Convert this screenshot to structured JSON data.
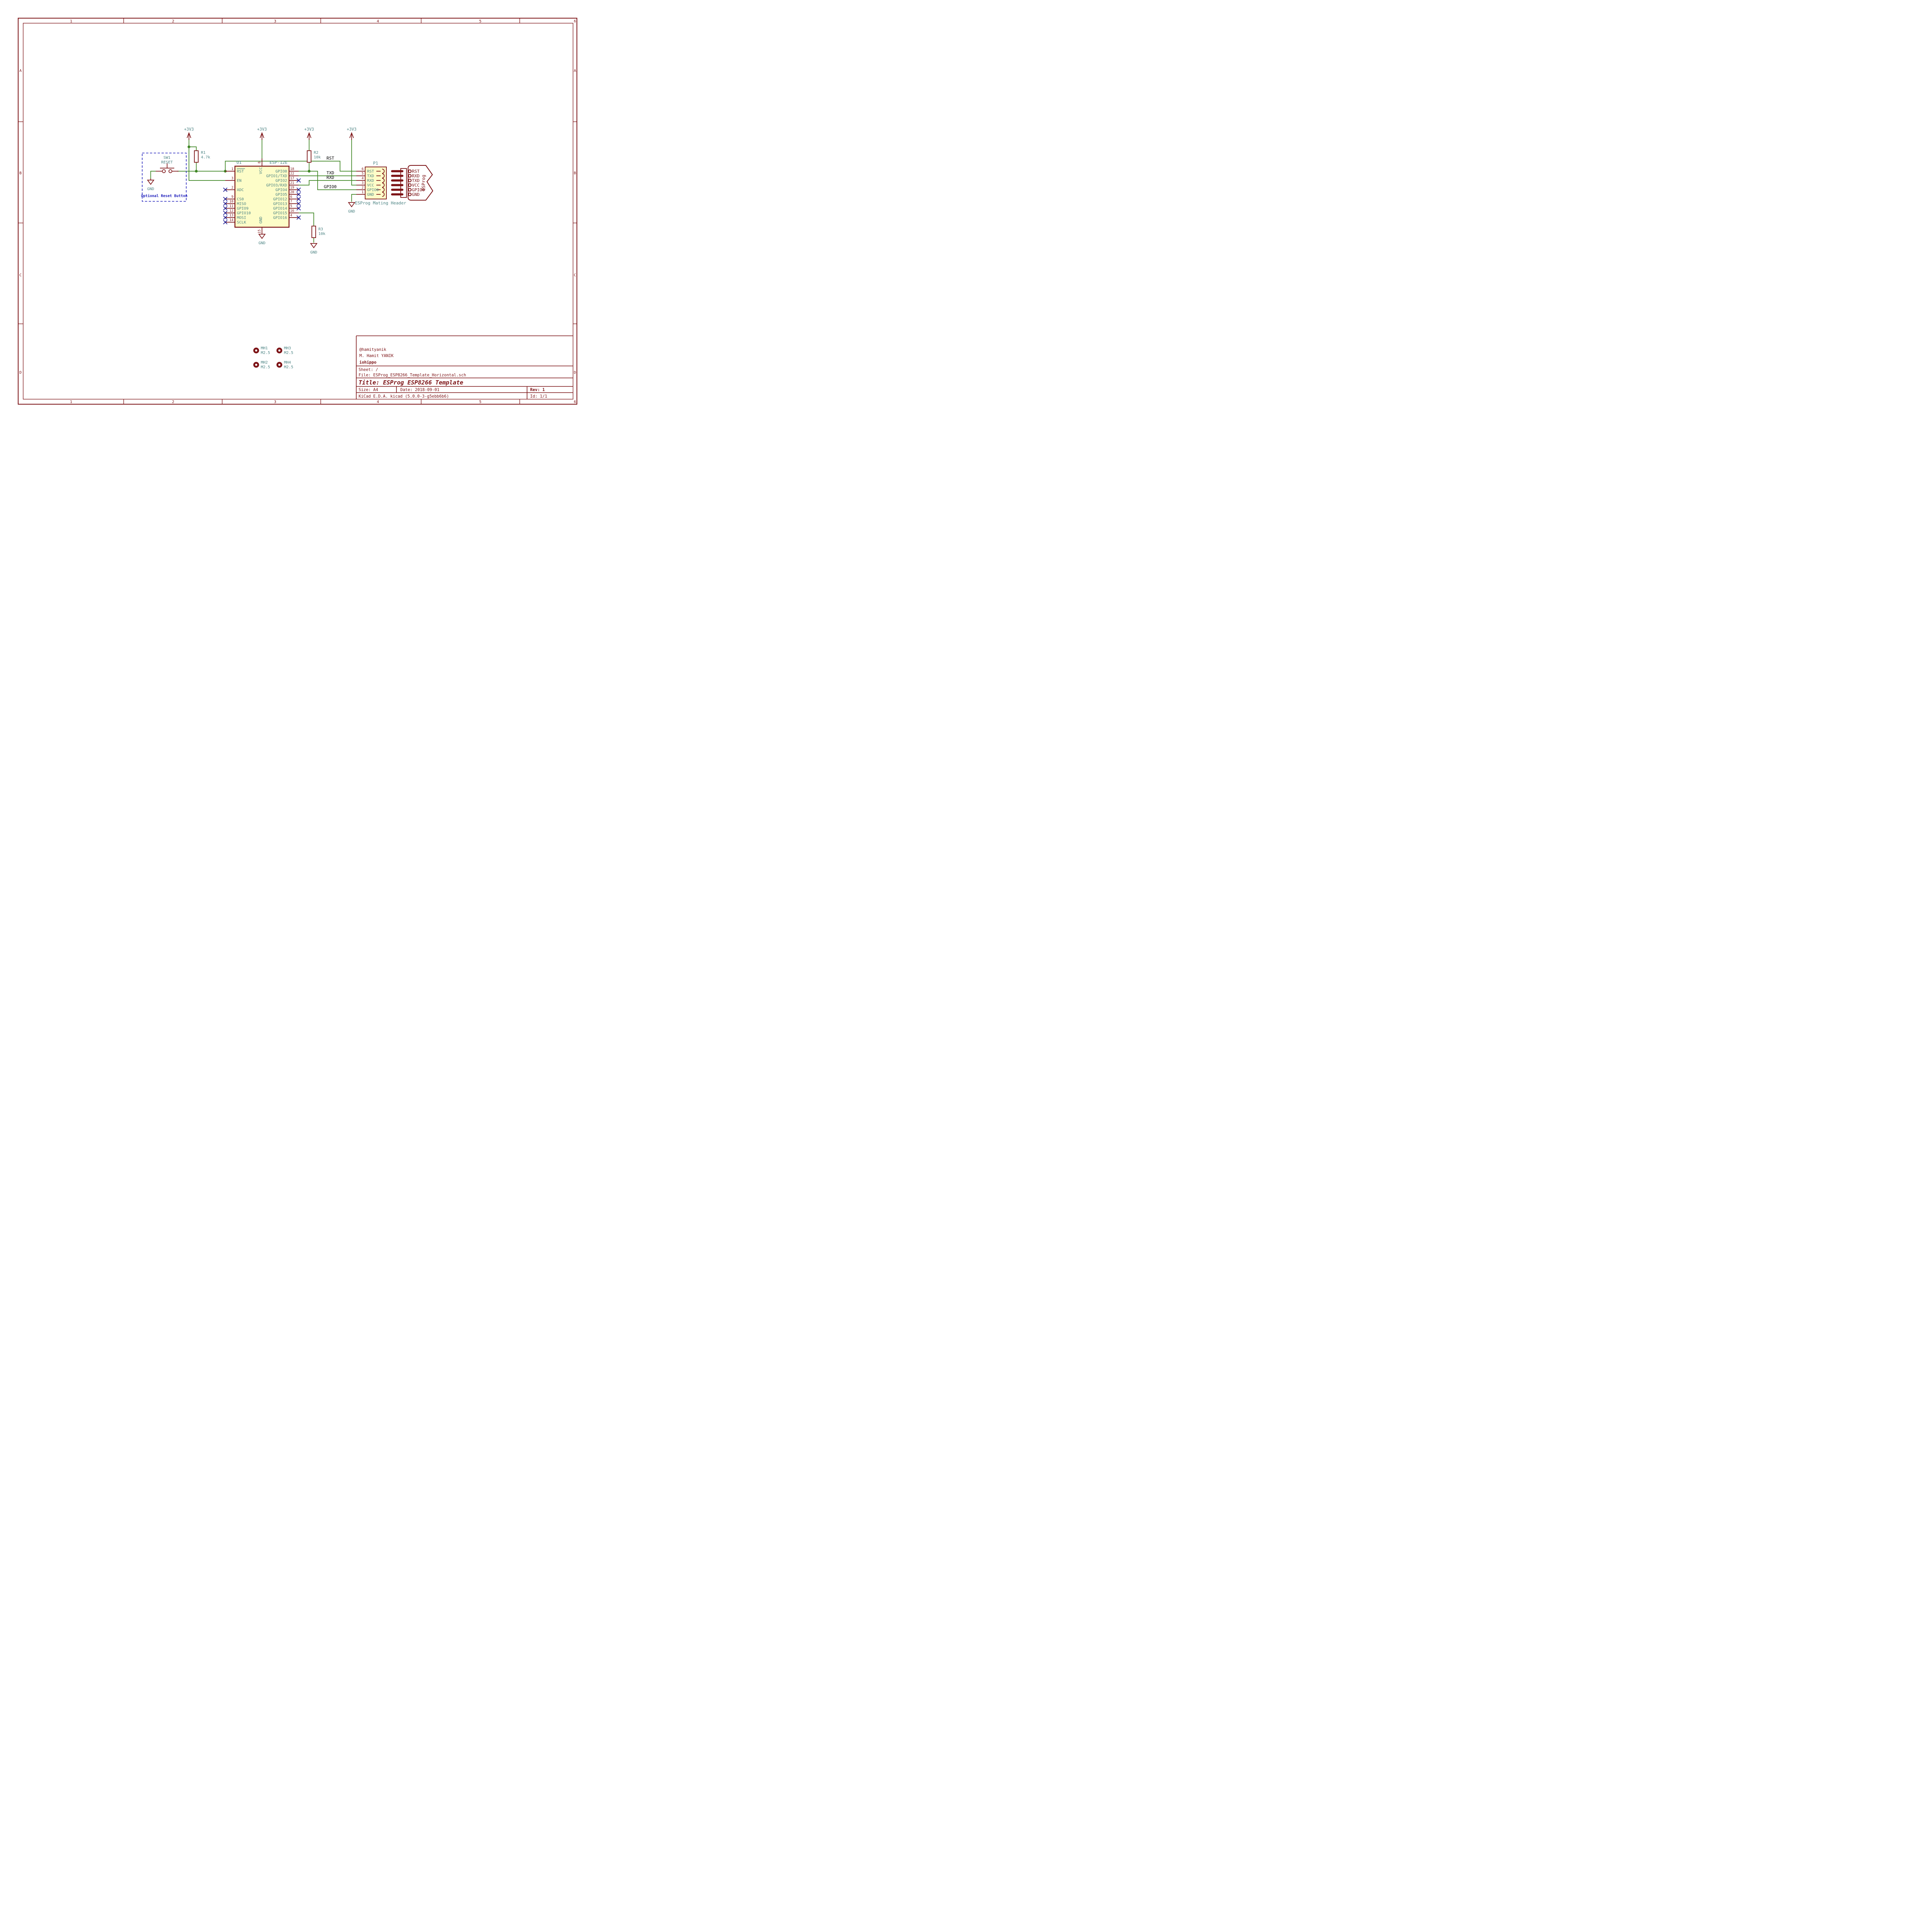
{
  "sheet": {
    "columns": [
      "1",
      "2",
      "3",
      "4",
      "5",
      "6"
    ],
    "rows": [
      "A",
      "B",
      "C",
      "D"
    ],
    "title_block": {
      "comment_handle": "@hamityanik",
      "comment_name": "M. Hamit YANIK",
      "comment_org": "iohippo",
      "sheet": "Sheet: /",
      "file": "File: ESProg_ESP8266_Template_Horizontal.sch",
      "title": "Title: ESProg ESP8266 Template",
      "size": "Size: A4",
      "date": "Date: 2018-09-01",
      "rev": "Rev: 1",
      "tool": "KiCad E.D.A.  kicad (5.0.0-3-g5ebb6b6)",
      "id": "Id: 1/1"
    }
  },
  "power": {
    "v33": "+3V3",
    "gnd": "GND"
  },
  "nets": {
    "rst": "RST",
    "txd": "TXD",
    "rxd": "RXD",
    "gpio0": "GPIO0"
  },
  "u1": {
    "ref": "U1",
    "value": "ESP-12E",
    "top": {
      "num": "8",
      "name": "VCC"
    },
    "bottom": {
      "num": "15",
      "name": "GND"
    },
    "left": [
      {
        "num": "1",
        "name": "RST"
      },
      {
        "num": "3",
        "name": "EN"
      },
      {
        "num": "2",
        "name": "ADC"
      },
      {
        "num": "9",
        "name": "CS0"
      },
      {
        "num": "10",
        "name": "MISO"
      },
      {
        "num": "11",
        "name": "GPIO9"
      },
      {
        "num": "12",
        "name": "GPIO10"
      },
      {
        "num": "13",
        "name": "MOSI"
      },
      {
        "num": "14",
        "name": "SCLK"
      }
    ],
    "right": [
      {
        "num": "18",
        "name": "GPIO0"
      },
      {
        "num": "22",
        "name": "GPIO1/TXD"
      },
      {
        "num": "17",
        "name": "GPIO2"
      },
      {
        "num": "21",
        "name": "GPIO3/RXD"
      },
      {
        "num": "19",
        "name": "GPIO4"
      },
      {
        "num": "20",
        "name": "GPIO5"
      },
      {
        "num": "6",
        "name": "GPIO12"
      },
      {
        "num": "7",
        "name": "GPIO13"
      },
      {
        "num": "5",
        "name": "GPIO14"
      },
      {
        "num": "16",
        "name": "GPIO15"
      },
      {
        "num": "4",
        "name": "GPIO16"
      }
    ]
  },
  "p1": {
    "ref": "P1",
    "note": "ESProg Mating Header",
    "pins": [
      {
        "num": "6",
        "name": "RST"
      },
      {
        "num": "5",
        "name": "TXD"
      },
      {
        "num": "4",
        "name": "RXD"
      },
      {
        "num": "3",
        "name": "VCC"
      },
      {
        "num": "2",
        "name": "GPIO0"
      },
      {
        "num": "1",
        "name": "GND"
      }
    ]
  },
  "esprog": {
    "label": "ESProg",
    "pins": [
      "RST",
      "RXD",
      "TXD",
      "VCC",
      "GPIO0",
      "GND"
    ]
  },
  "sw1": {
    "ref": "SW1",
    "value": "RESET",
    "note": "Optional Reset Button"
  },
  "r1": {
    "ref": "R1",
    "value": "4.7k"
  },
  "r2": {
    "ref": "R2",
    "value": "10k"
  },
  "r3": {
    "ref": "R3",
    "value": "10k"
  },
  "mounting_holes": [
    {
      "ref": "MH1",
      "value": "M2.5"
    },
    {
      "ref": "MH2",
      "value": "M2.5"
    },
    {
      "ref": "MH3",
      "value": "M2.5"
    },
    {
      "ref": "MH4",
      "value": "M2.5"
    }
  ],
  "colors": {
    "component": "#7c1215",
    "wire": "#3f8624",
    "fields": "#4e8585",
    "notes": "#2323bd",
    "no_connect": "#202095",
    "body_fill": "#fdfdc8"
  }
}
